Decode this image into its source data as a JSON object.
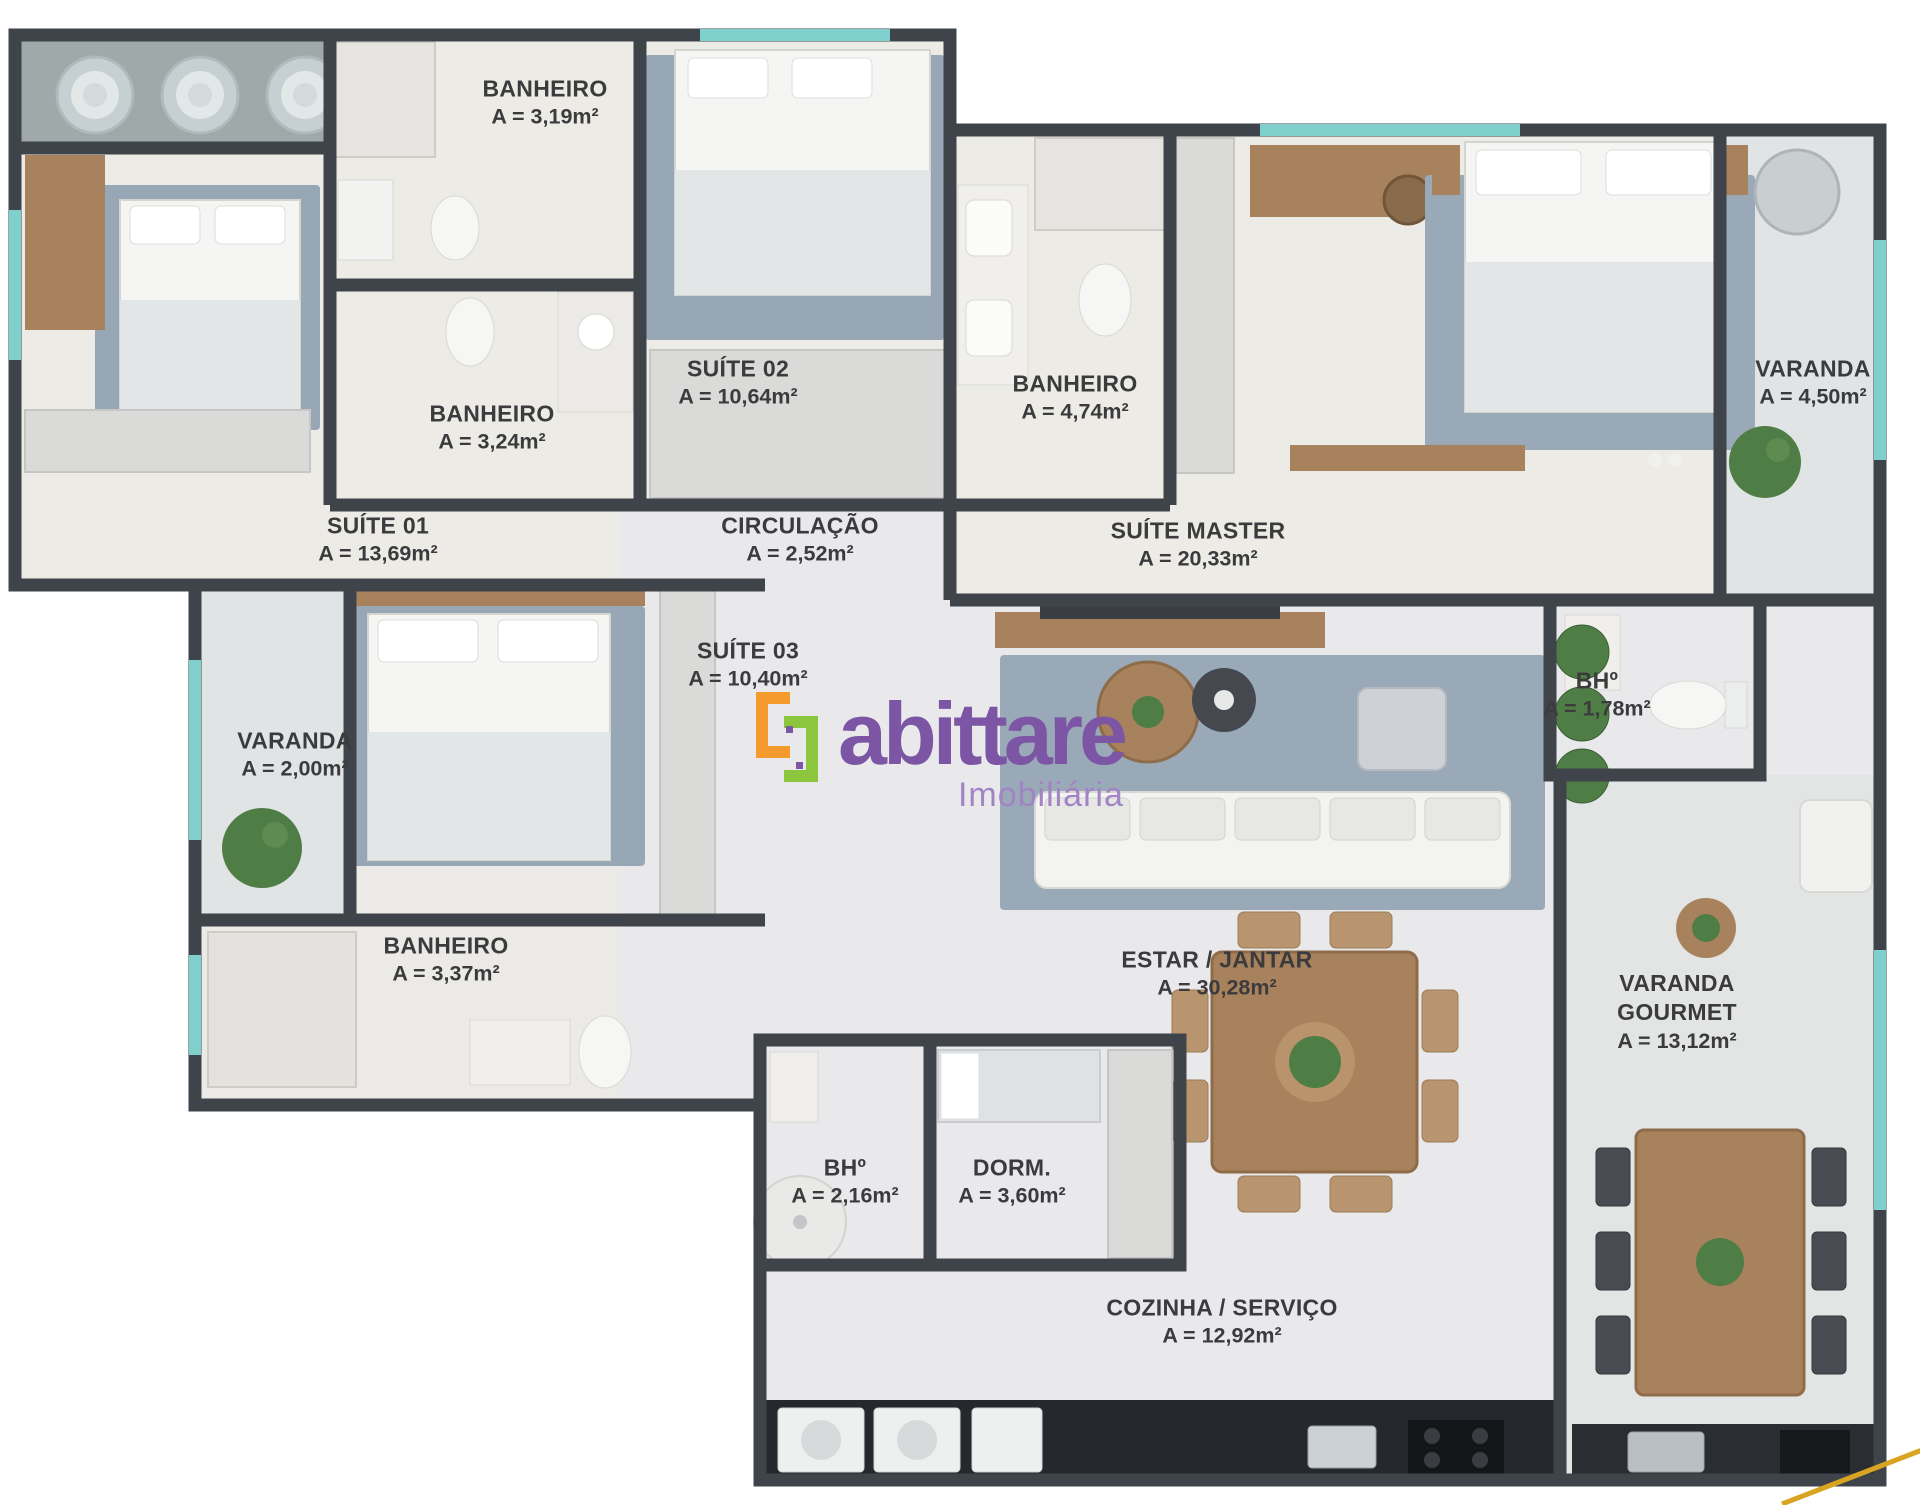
{
  "plan": {
    "rooms": [
      {
        "id": "banheiro-suite02",
        "name": "BANHEIRO",
        "area": "A = 3,19m²"
      },
      {
        "id": "suite-02",
        "name": "SUÍTE 02",
        "area": "A = 10,64m²"
      },
      {
        "id": "banheiro-suite01",
        "name": "BANHEIRO",
        "area": "A = 3,24m²"
      },
      {
        "id": "suite-01",
        "name": "SUÍTE 01",
        "area": "A = 13,69m²"
      },
      {
        "id": "circulacao",
        "name": "CIRCULAÇÃO",
        "area": "A = 2,52m²"
      },
      {
        "id": "banheiro-master",
        "name": "BANHEIRO",
        "area": "A = 4,74m²"
      },
      {
        "id": "suite-master",
        "name": "SUÍTE MASTER",
        "area": "A = 20,33m²"
      },
      {
        "id": "varanda-suite-master",
        "name": "VARANDA",
        "area": "A = 4,50m²"
      },
      {
        "id": "suite-03",
        "name": "SUÍTE 03",
        "area": "A = 10,40m²"
      },
      {
        "id": "varanda-suite03",
        "name": "VARANDA",
        "area": "A = 2,00m²"
      },
      {
        "id": "bh-social",
        "name": "BHº",
        "area": "A = 1,78m²"
      },
      {
        "id": "banheiro-suite03",
        "name": "BANHEIRO",
        "area": "A = 3,37m²"
      },
      {
        "id": "estar-jantar",
        "name": "ESTAR / JANTAR",
        "area": "A = 30,28m²"
      },
      {
        "id": "varanda-gourmet",
        "name": "VARANDA\nGOURMET",
        "area": "A = 13,12m²"
      },
      {
        "id": "bh-servico",
        "name": "BHº",
        "area": "A = 2,16m²"
      },
      {
        "id": "dorm",
        "name": "DORM.",
        "area": "A = 3,60m²"
      },
      {
        "id": "cozinha-servico",
        "name": "COZINHA / SERVIÇO",
        "area": "A = 12,92m²"
      }
    ],
    "logo": {
      "brand": "abittare",
      "tagline": "Imobiliária"
    },
    "colors": {
      "wall": "#3f444b",
      "floor_warm": "#edebe6",
      "floor_cool": "#e9e9eb",
      "floor_varanda": "#e0e4e4",
      "terrace": "#9fa9a9",
      "rug_blue": "#97a7b6",
      "wood": "#a8825c",
      "wardrobe": "#dadbd9",
      "plant_green": "#4f7d46",
      "counter_dark": "#25282d",
      "window_teal": "#7fd0cd",
      "logo_purple": "#7d55a5",
      "logo_orange": "#f59b2d",
      "logo_green": "#8cc63e",
      "gold_line": "#d9a421"
    }
  }
}
